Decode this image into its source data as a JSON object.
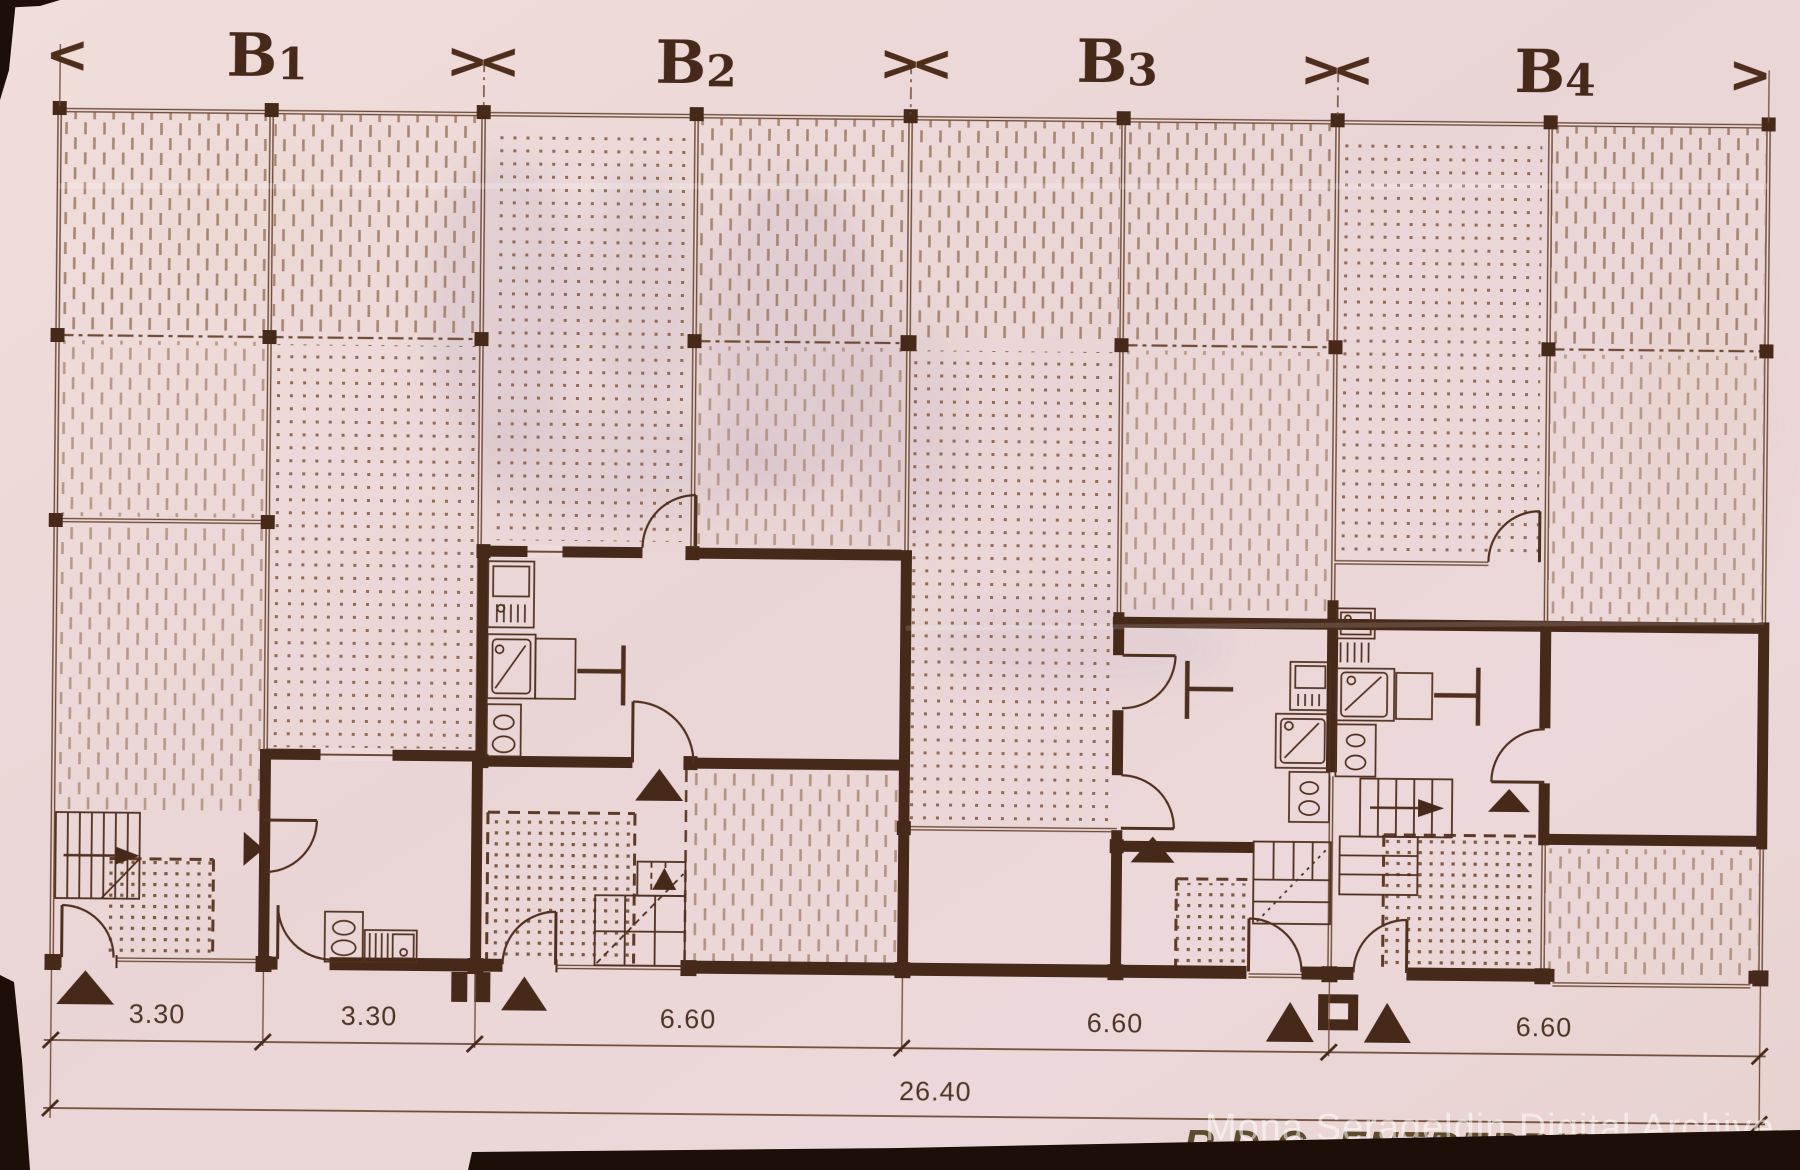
{
  "document": {
    "kind": "scanned architectural floor plan",
    "title": "R.D.C.-ENTREPRISE",
    "watermark": "Mona Serageldin Digital Archive"
  },
  "header": {
    "edge_left": "<",
    "edge_right": ">",
    "separator": "><",
    "bays": [
      {
        "base": "B",
        "index": "1"
      },
      {
        "base": "B",
        "index": "2"
      },
      {
        "base": "B",
        "index": "3"
      },
      {
        "base": "B",
        "index": "4"
      }
    ]
  },
  "dimensions": {
    "segments": [
      "3.30",
      "3.30",
      "6.60",
      "6.60",
      "6.60"
    ],
    "total": "26.40"
  },
  "colors": {
    "paper": "#ecd8d6",
    "ink": "#47291a",
    "thin_line": "#6f4c36",
    "hatch": "#a07c63",
    "dots": "#8f6c53",
    "patio_dots": "#7c5a42",
    "film_edge": "#1d0e07",
    "title_ink": "#5e4b2b",
    "watermark": "#ffffff"
  }
}
